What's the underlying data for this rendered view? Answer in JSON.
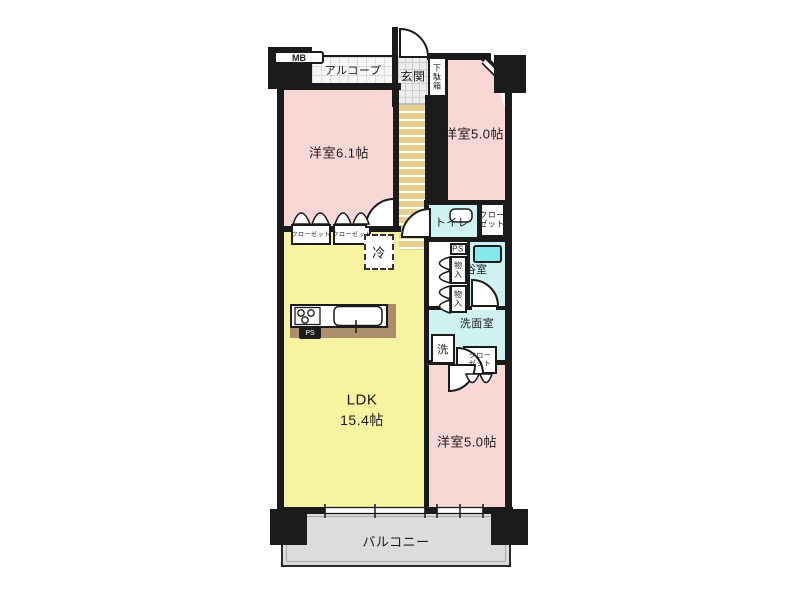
{
  "labels": {
    "mb": "MB",
    "alcove": "アルコープ",
    "entrance": "玄関",
    "shoe_cabinet": "下駄箱",
    "bedroom_ne": "洋室5.0帖",
    "bedroom_nw": "洋室6.1帖",
    "bedroom_se": "洋室5.0帖",
    "toilet": "トイレ",
    "closet_ne": "クローゼット",
    "closet_se": "クローゼット",
    "closet_nw_left": "クローゼット",
    "closet_nw_right": "クローゼット",
    "ps_pipe_space": "PS",
    "ps_kitchen": "PS",
    "storage_upper": "物入",
    "storage_lower": "物入",
    "bath": "浴室",
    "washroom": "洗面室",
    "washer": "洗",
    "fridge": "冷",
    "ldk_name": "LDK",
    "ldk_size": "15.4帖",
    "balcony": "バルコニー"
  },
  "colors": {
    "wall": "#1b1b1b",
    "room_pink": "#f8d7d4",
    "room_yellow": "#f7f3a1",
    "room_cyan": "#cdf2ef",
    "tub_cyan": "#85e8ea",
    "hall_tan": "#e7cf8d",
    "balcony_gray": "#dcdcdc",
    "counter_brown": "#ab8e6c",
    "tile_gray": "#ededed"
  }
}
